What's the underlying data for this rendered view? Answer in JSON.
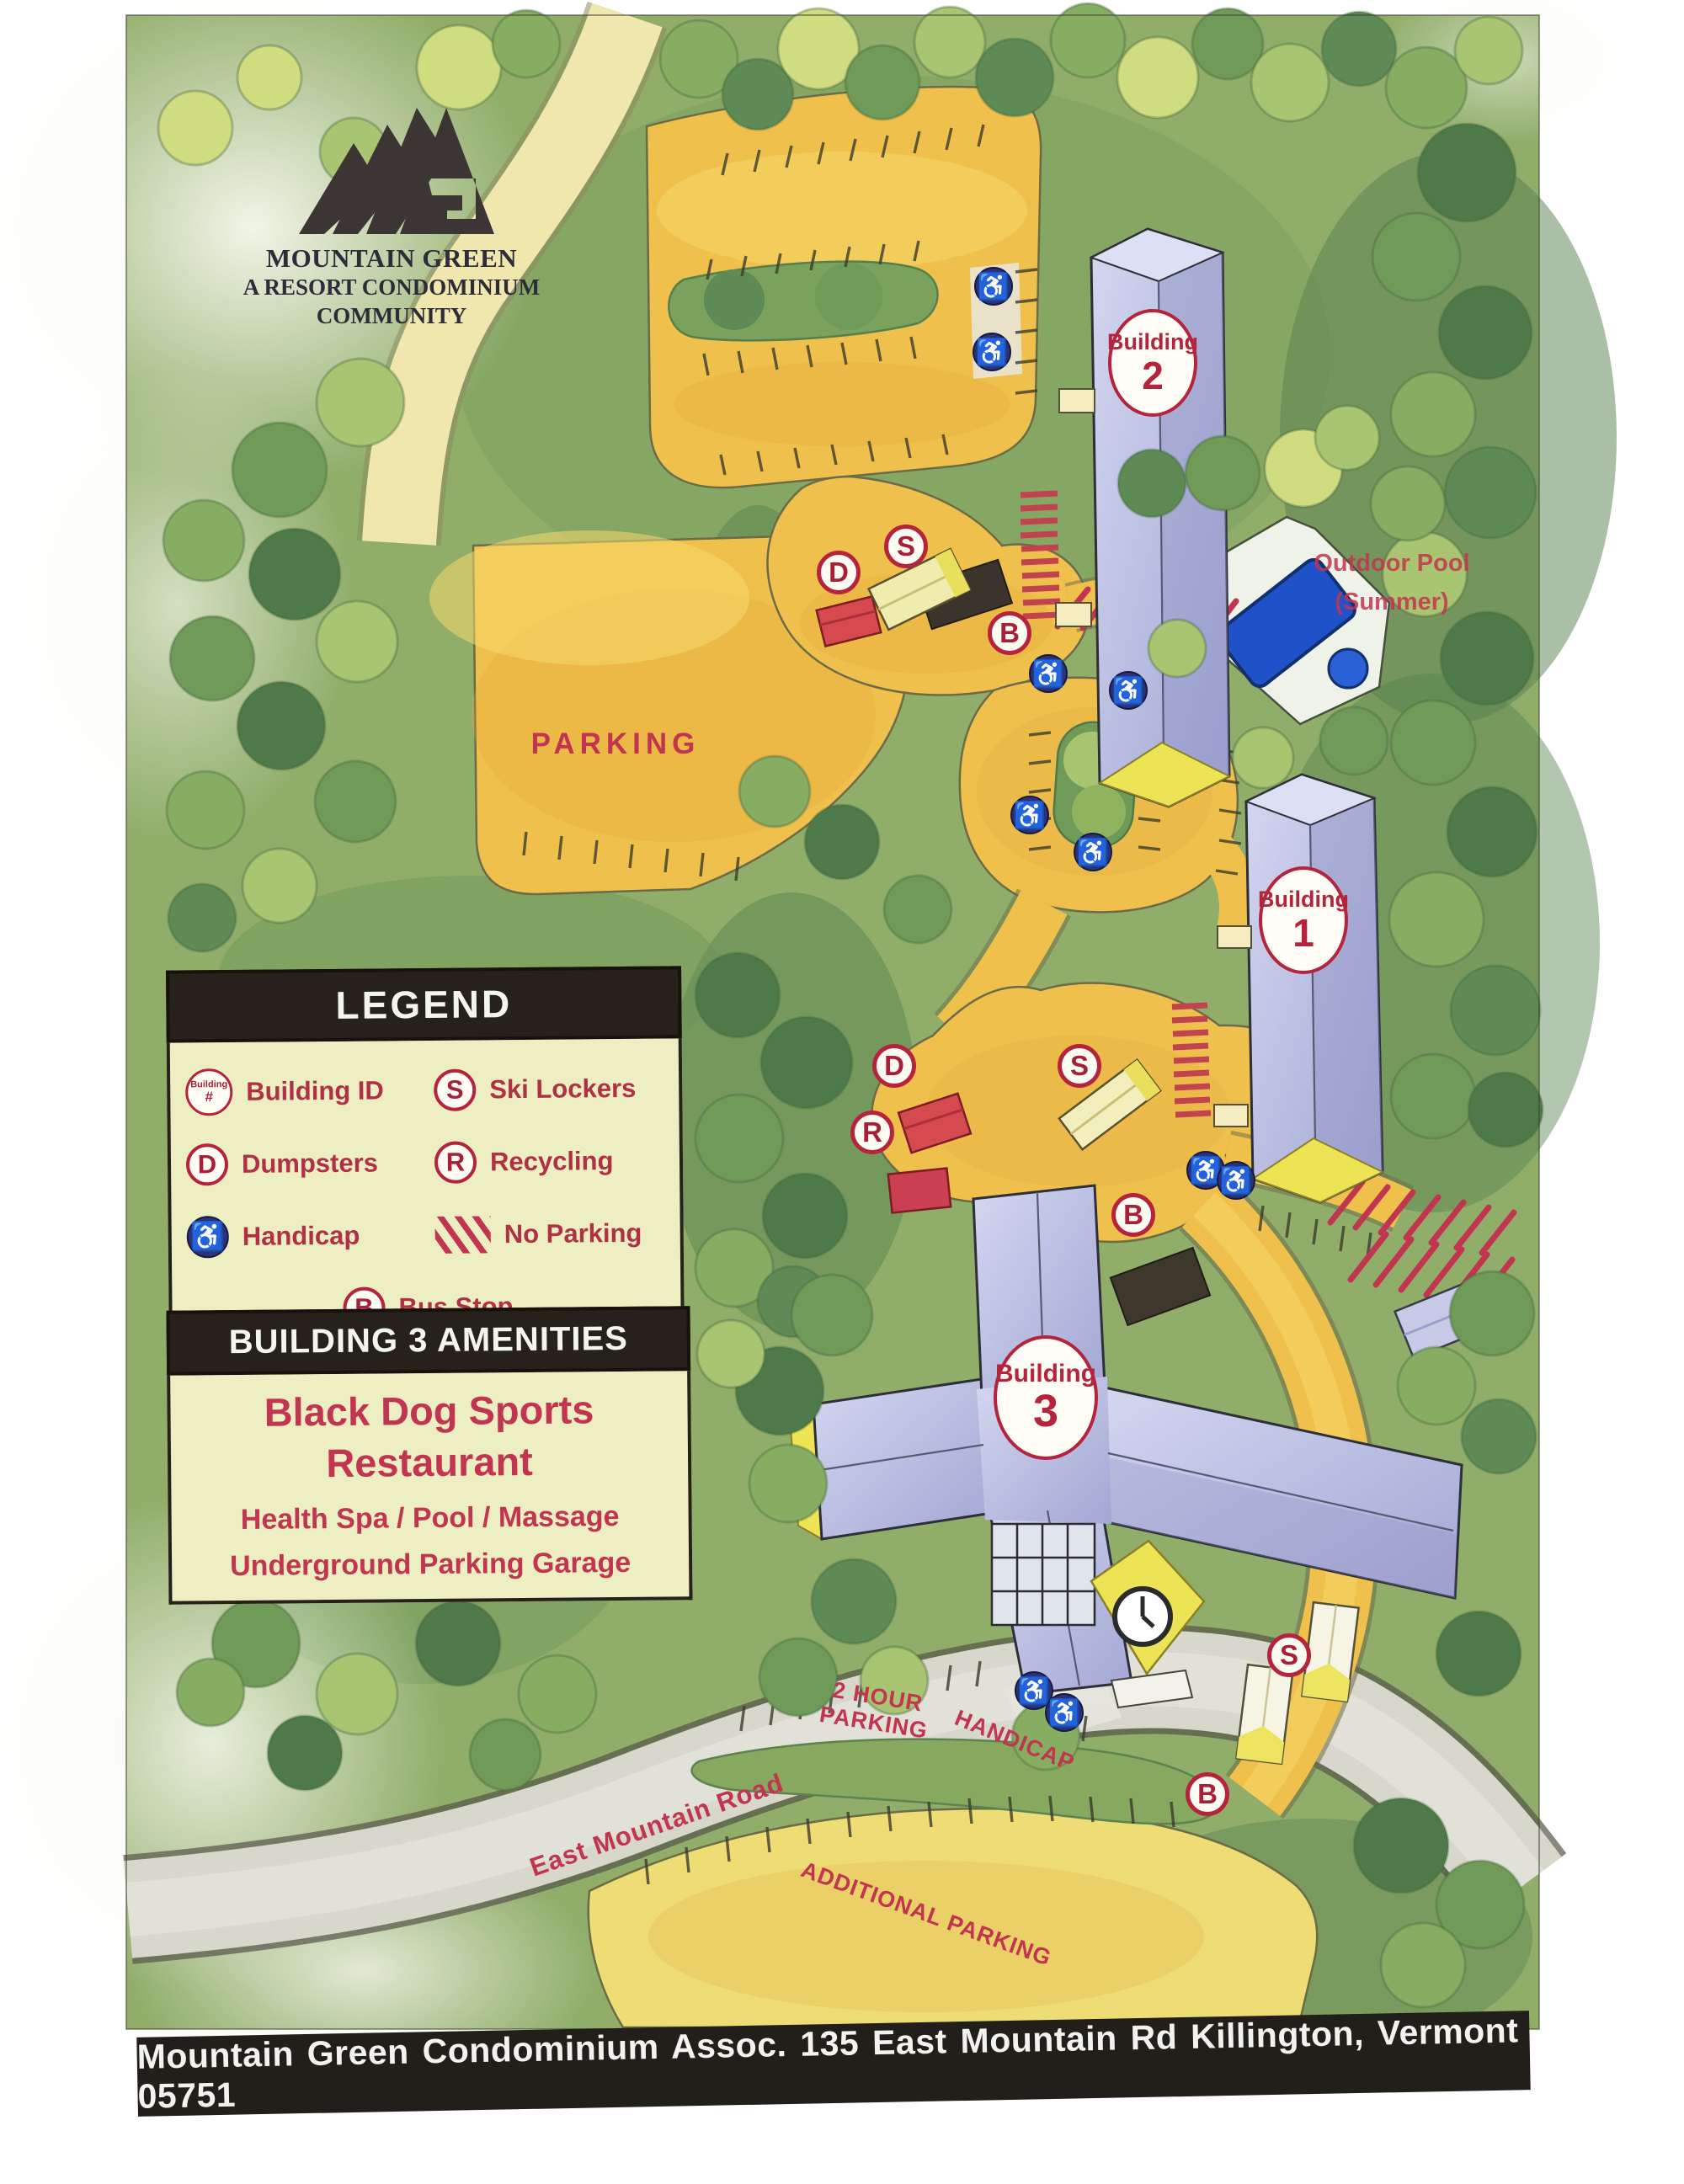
{
  "logo": {
    "line1": "MOUNTAIN GREEN",
    "line2": "A RESORT CONDOMINIUM",
    "line3": "COMMUNITY"
  },
  "legend": {
    "title": "LEGEND",
    "building_icon_line1": "Building",
    "building_icon_line2": "#",
    "items": [
      {
        "key": "building-id",
        "label": "Building ID"
      },
      {
        "key": "ski-lockers",
        "letter": "S",
        "label": "Ski Lockers"
      },
      {
        "key": "dumpsters",
        "letter": "D",
        "label": "Dumpsters"
      },
      {
        "key": "recycling",
        "letter": "R",
        "label": "Recycling"
      },
      {
        "key": "handicap",
        "label": "Handicap"
      },
      {
        "key": "no-parking",
        "label": "No Parking"
      },
      {
        "key": "bus-stop",
        "letter": "B",
        "label": "Bus Stop"
      }
    ]
  },
  "amenities": {
    "title": "BUILDING 3 AMENITIES",
    "lines": [
      "Black Dog Sports",
      "Restaurant",
      "Health Spa / Pool / Massage",
      "Underground Parking Garage"
    ]
  },
  "map_labels": {
    "parking": "PARKING",
    "outdoor_pool": "Outdoor Pool",
    "outdoor_pool_sub": "(Summer)",
    "two_hour_parking": "2 HOUR PARKING",
    "handicap": "HANDICAP",
    "east_mountain_road": "East Mountain Road",
    "additional_parking": "ADDITIONAL PARKING"
  },
  "buildings": [
    {
      "label": "Building",
      "number": "2"
    },
    {
      "label": "Building",
      "number": "1"
    },
    {
      "label": "Building",
      "number": "3"
    }
  ],
  "markers": [
    {
      "letter": "D"
    },
    {
      "letter": "S"
    },
    {
      "letter": "B"
    },
    {
      "letter": "D"
    },
    {
      "letter": "R"
    },
    {
      "letter": "S"
    },
    {
      "letter": "B"
    },
    {
      "letter": "S"
    },
    {
      "letter": "B"
    }
  ],
  "icons": {
    "handicap": "♿"
  },
  "footer": {
    "text": "Mountain Green Condominium Assoc. 135 East Mountain Rd  Killington, Vermont 05751"
  },
  "colors": {
    "map_red": "#c23550",
    "marker_red": "#a81f38",
    "legend_cream": "#edeec2",
    "header_dark": "#27211b",
    "road_yellow": "#efc04b",
    "building_lavender": "#b9bde0",
    "pool_blue": "#2255cc",
    "handicap_blue": "#2c3178"
  }
}
